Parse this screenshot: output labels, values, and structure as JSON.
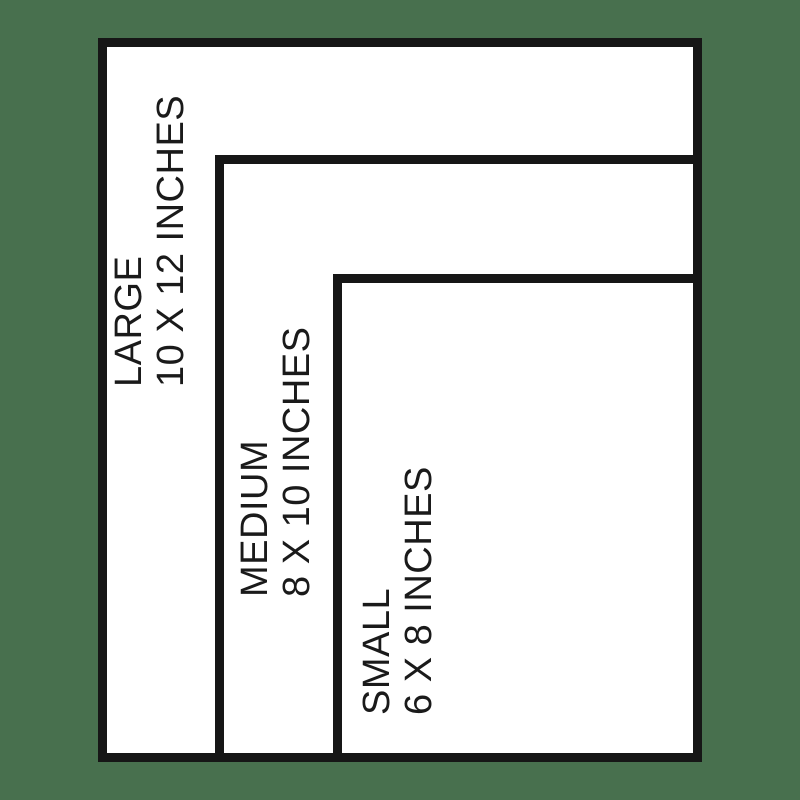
{
  "colors": {
    "background": "#48704e",
    "line": "#161616",
    "panel": "#ffffff",
    "text": "#1a1a1a"
  },
  "sizes": [
    {
      "label": "LARGE",
      "dimensions": "10 X 12 INCHES"
    },
    {
      "label": "MEDIUM",
      "dimensions": "8 X 10 INCHES"
    },
    {
      "label": "SMALL",
      "dimensions": "6 X 8 INCHES"
    }
  ]
}
